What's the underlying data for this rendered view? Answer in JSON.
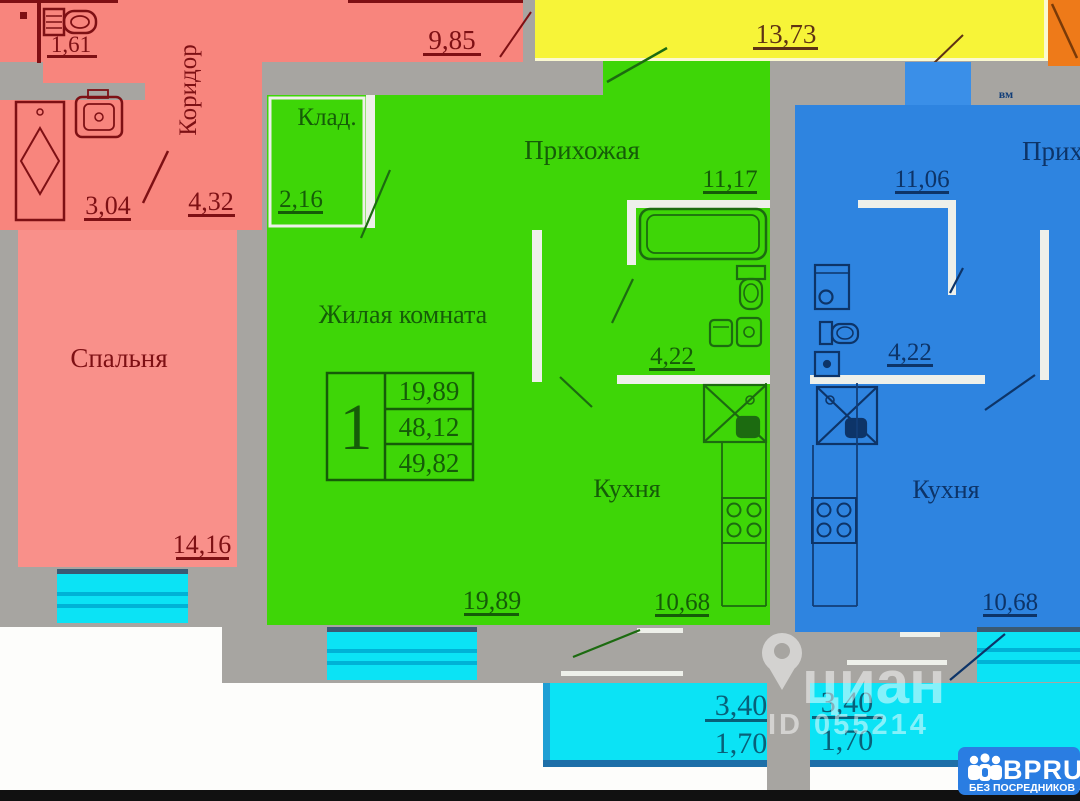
{
  "plan": {
    "pink": {
      "wc_area": "1,61",
      "corridor_label": "Коридор",
      "room_area": "9,85",
      "bath_area": "3,04",
      "hall_area": "4,32",
      "bedroom_label": "Спальня",
      "bedroom_area": "14,16"
    },
    "green": {
      "storage_label": "Клад.",
      "storage_area": "2,16",
      "hall_label": "Прихожая",
      "hall_area": "11,17",
      "living_label": "Жилая комната",
      "living_area": "19,89",
      "bath_area": "4,22",
      "kitchen_label": "Кухня",
      "kitchen_area": "10,68",
      "stamp": {
        "rooms": "1",
        "living_area": "19,89",
        "usable_area": "48,12",
        "total_area": "49,82"
      }
    },
    "blue": {
      "hall_label": "Прихожая",
      "hall_area": "11,06",
      "bath_area": "4,22",
      "kitchen_label": "Кухня",
      "kitchen_area": "10,68",
      "vent_label": "вм"
    },
    "yellow": {
      "area": "13,73"
    },
    "balcony_left": {
      "area_top": "3,40",
      "area_bottom": "1,70"
    },
    "balcony_right": {
      "area_top": "3,40",
      "area_bottom": "1,70"
    }
  },
  "watermark": {
    "brand": "циан",
    "id_text": "ID 055214"
  },
  "logo": {
    "brand": "BPRU",
    "tagline": "БЕЗ ПОСРЕДНИКОВ"
  },
  "colors": {
    "pink": "#f8857d",
    "green": "#3ed607",
    "blue": "#2e84e0",
    "yellow": "#f7f438",
    "cyan": "#0be3f5",
    "orange": "#ee7a19",
    "wall_gray": "#a7a5a1",
    "logo_blue": "#2a7de2"
  }
}
